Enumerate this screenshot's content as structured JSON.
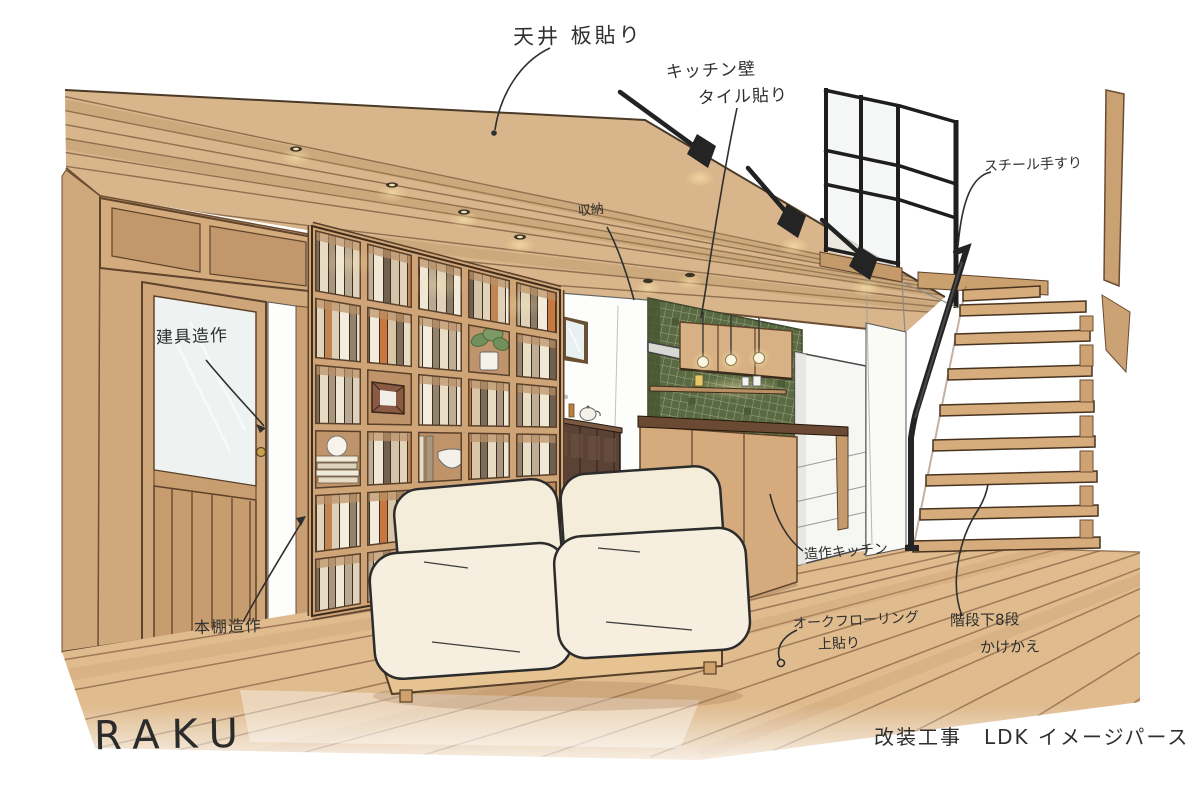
{
  "scene": {
    "type": "hand-drawn interior perspective sketch",
    "room": "LDK"
  },
  "annotations": {
    "ceiling": "天井 板貼り",
    "kitchen_wall_line1": "キッチン壁",
    "kitchen_wall_line2": "タイル貼り",
    "storage": "収納",
    "steel_handrail": "スチール手すり",
    "door_joinery": "建具造作",
    "bookshelf_joinery": "本棚造作",
    "custom_kitchen": "造作キッチン",
    "flooring_line1": "オークフローリング",
    "flooring_line2": "上貼り",
    "stairs_line1": "階段下8段",
    "stairs_line2": "かけかえ"
  },
  "footer": {
    "signature": "RAKU",
    "caption": "改装工事　LDK イメージパース"
  },
  "colors": {
    "paper": "#ffffff",
    "wood_ceiling": "#d8b58a",
    "wood_wall": "#cfa87c",
    "wood_floor": "#dfbb8e",
    "bookshelf_wood": "#cfa477",
    "tile_green": "#5a6a42",
    "counter_top": "#6b4a33",
    "sofa_cream": "#f4edda",
    "steel_black": "#262626",
    "ink": "#2f2f2f",
    "brass_knob": "#c9a24b"
  }
}
